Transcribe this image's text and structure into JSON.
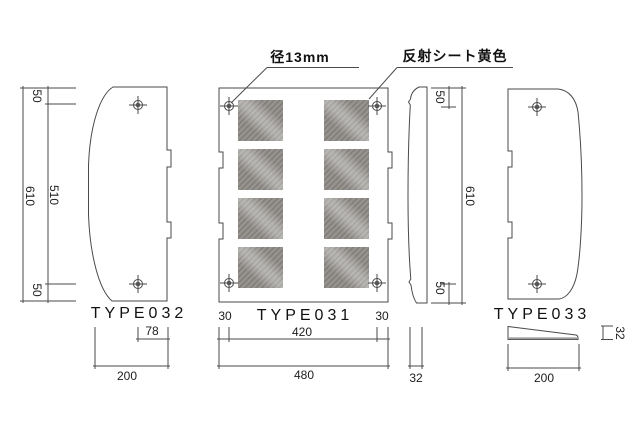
{
  "annotations": {
    "hole_diameter": "径13mm",
    "reflective_sheet": "反射シート黄色"
  },
  "type032": {
    "label": "TYPE032",
    "dim_top_offset": "50",
    "dim_inner_height": "510",
    "dim_overall_height": "610",
    "dim_bottom_offset": "50",
    "dim_hole_to_edge": "78",
    "dim_width": "200"
  },
  "type031": {
    "label": "TYPE031",
    "dim_left_offset": "30",
    "dim_hole_span": "420",
    "dim_right_offset": "30",
    "dim_overall_width": "480"
  },
  "type031_side": {
    "dim_top_offset": "50",
    "dim_overall_height": "610",
    "dim_bottom_offset": "50",
    "dim_thickness": "32"
  },
  "type033": {
    "label": "TYPE033",
    "dim_height": "32",
    "dim_width": "200"
  },
  "colors": {
    "line": "#4a4a4a",
    "hatch_base": "#96938f",
    "hatch_stripe": "#7d7a76"
  }
}
